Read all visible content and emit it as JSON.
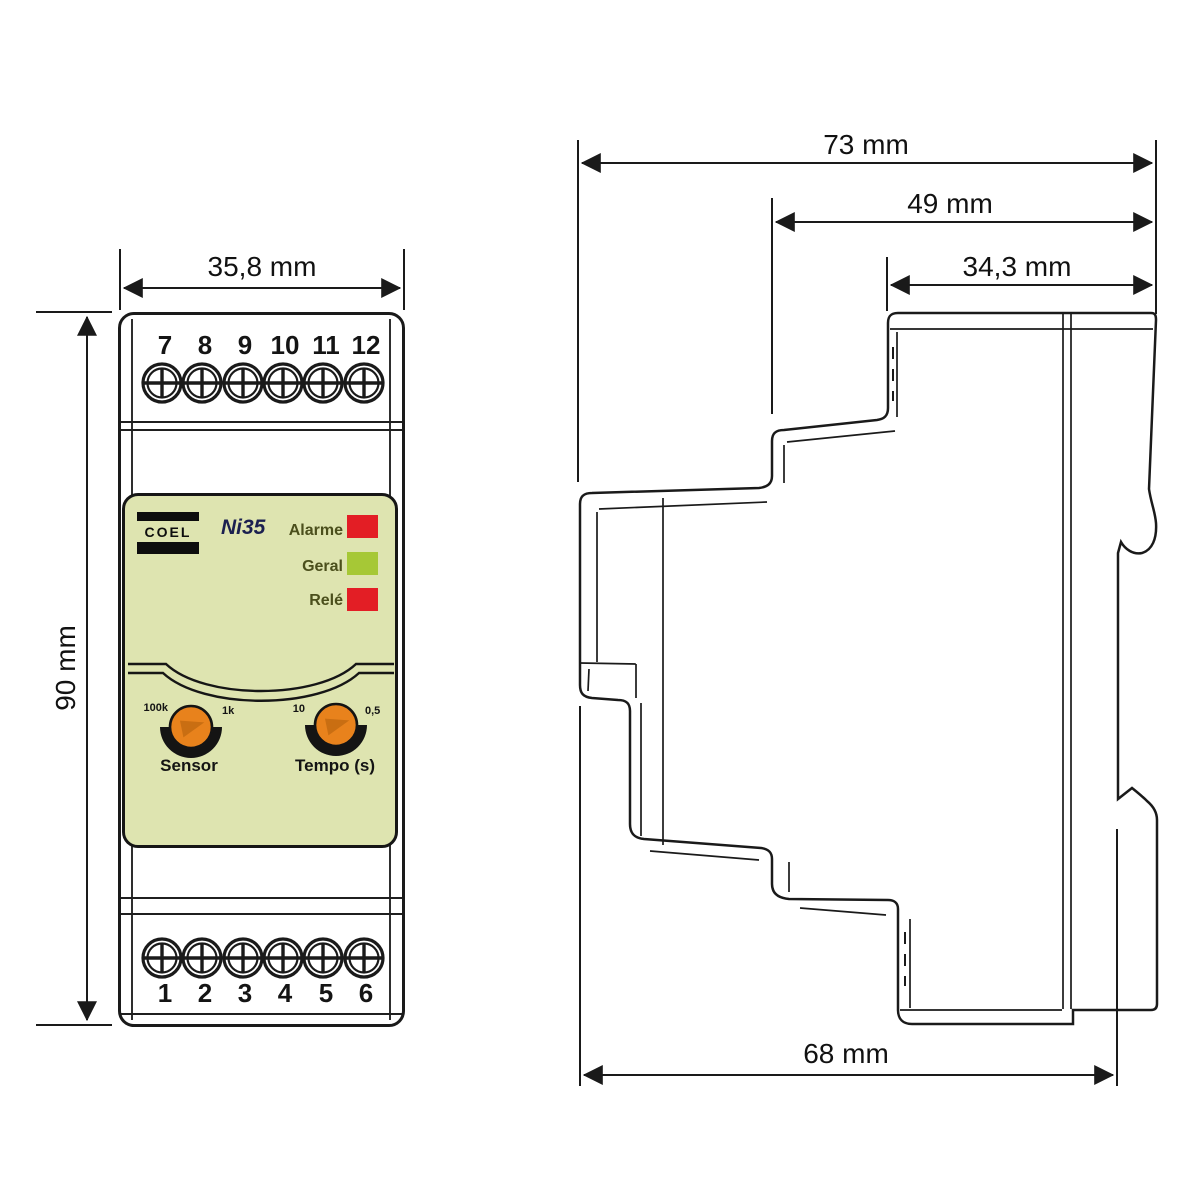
{
  "front_view": {
    "width_dim": "35,8 mm",
    "height_dim": "90 mm",
    "terminals_top": [
      "7",
      "8",
      "9",
      "10",
      "11",
      "12"
    ],
    "terminals_bottom": [
      "1",
      "2",
      "3",
      "4",
      "5",
      "6"
    ],
    "brand": "COEL",
    "model": "Ni35",
    "leds": [
      {
        "label": "Alarme",
        "color": "#e31e25"
      },
      {
        "label": "Geral",
        "color": "#a6c836"
      },
      {
        "label": "Relé",
        "color": "#e31e25"
      }
    ],
    "knobs": [
      {
        "label": "Sensor",
        "scale_left": "100k",
        "scale_right": "1k"
      },
      {
        "label": "Tempo (s)",
        "scale_left": "10",
        "scale_right": "0,5"
      }
    ]
  },
  "side_view": {
    "depth_total_dim": "73 mm",
    "depth_upper_dim": "49 mm",
    "depth_top_dim": "34,3 mm",
    "depth_body_dim": "68 mm"
  },
  "colors": {
    "panel_bg": "#dee4b0",
    "knob_orange": "#e8821c",
    "led_red": "#e31e25",
    "led_green": "#a6c836",
    "line": "#1a1a1a",
    "model_text": "#1b2050"
  }
}
